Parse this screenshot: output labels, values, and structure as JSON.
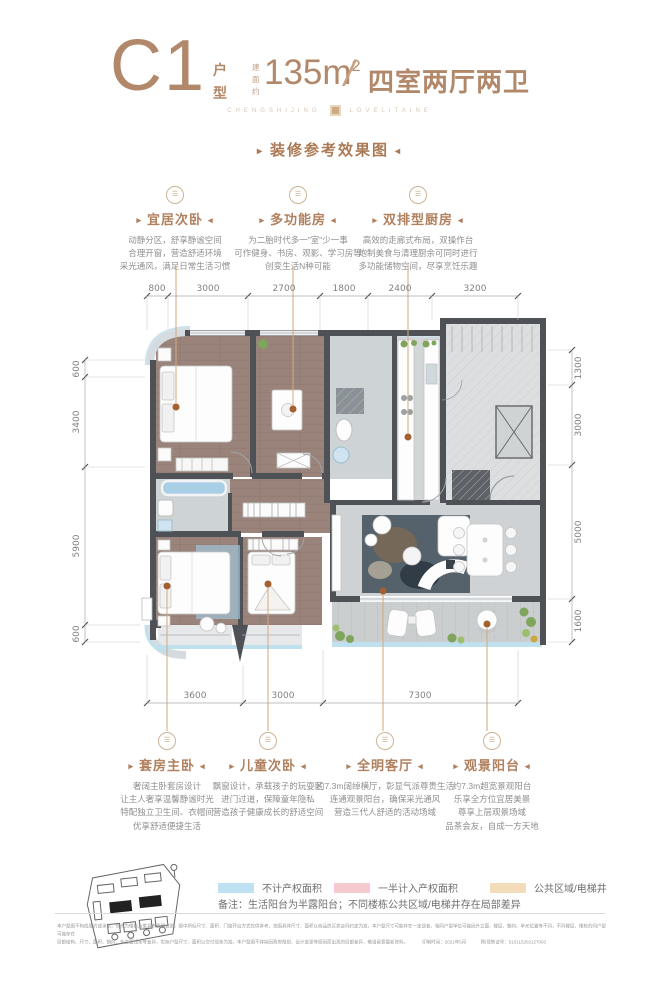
{
  "header": {
    "plan_code": "C1",
    "plan_type_chars": [
      "户",
      "型"
    ],
    "area_prefix_chars": [
      "建",
      "面",
      "约"
    ],
    "area_value": "135m",
    "area_sup": "2",
    "separator": "/",
    "layout_label": "四室两厅两卫",
    "tagline_left": "CHENGSHIJING",
    "tagline_right": "LOVELITAINE",
    "render_note": "装修参考效果图"
  },
  "top_callouts": [
    {
      "title": "宜居次卧",
      "lines": [
        "动静分区，舒享静谧空间",
        "合理开窗，营造舒适环境",
        "采光通风，满足日常生活习惯"
      ]
    },
    {
      "title": "多功能房",
      "lines": [
        "为二胎时代多一\"室\"少一事",
        "可作健身、书房、观影、学习房等",
        "创变生活N种可能"
      ]
    },
    {
      "title": "双排型厨房",
      "lines": [
        "高效的走廊式布局，双操作台",
        "炮制美食与清理厨余可同时进行",
        "多功能储物空间，尽享烹饪乐趣"
      ]
    }
  ],
  "bottom_callouts": [
    {
      "title": "套房主卧",
      "lines": [
        "奢阔主卧套房设计",
        "让主人奢享温馨静谧时光",
        "特配独立卫生间、衣帽间",
        "优享舒适便捷生活"
      ]
    },
    {
      "title": "儿童次卧",
      "lines": [
        "飘窗设计，承载孩子的玩耍区",
        "进门过道，保障童年隐私",
        "营造孩子健康成长的舒适空间",
        ""
      ]
    },
    {
      "title": "全明客厅",
      "lines": [
        "约7.3m阔绰横厅，彰显气派尊贵生活",
        "连通观景阳台，确保采光通风",
        "营造三代人舒适的活动场域",
        ""
      ]
    },
    {
      "title": "观景阳台",
      "lines": [
        "约7.3m超宽景观阳台",
        "乐享全方位宜居美景",
        "尊享上层观景场域",
        "品茶会友，自成一方天地"
      ]
    }
  ],
  "dims": {
    "top": [
      "800",
      "3000",
      "2700",
      "1800",
      "2400",
      "3200"
    ],
    "left": [
      "600",
      "3400",
      "5900",
      "600"
    ],
    "right": [
      "1300",
      "3000",
      "5000",
      "1600"
    ],
    "bottom": [
      "3600",
      "3000",
      "7300"
    ]
  },
  "legend": {
    "items": [
      {
        "label": "不计产权面积",
        "color": "#bfe2f2"
      },
      {
        "label": "一半计入产权面积",
        "color": "#f6c9cf"
      },
      {
        "label": "公共区域/电梯井",
        "color": "#f2dcba"
      }
    ],
    "note": "备注：生活阳台为半露阳台；不同楼栋公共区域/电梯井存在局部差异"
  },
  "disclaimer": {
    "line1": "本户型图不构成要约或承诺，仅作为楼栋及家具布置建议图，图中所标尺寸、面积、门窗开启方式仅供参考，范围具体尺寸、面积以商品房买卖合同约定为准，本户型尺寸可能存在一定误差，相同户型单位可能因外立面、楼层、朝向、单元位置等不同，不同楼层、楼栋的同户型可能存在",
    "line2": "局部结构、尺寸、面积、朝向、外立面线条等差异，实际户型尺寸、面积以交付现状为准，本户型图不排除因政府规划、设计变更等原因而出现的局部差异，敬请留意最新资料。",
    "print_time": "印制时间：2021年5月",
    "license": "预/现售证号：510115202127003"
  },
  "colors": {
    "brand_brown": "#b2886a",
    "callout_brown": "#b0805f",
    "leader_tan": "#d2a97e",
    "leader_dot": "#a4602e",
    "wall_gray": "#4e5155",
    "wood_floor": "#99837a",
    "tile_gray": "#ced2d4"
  }
}
